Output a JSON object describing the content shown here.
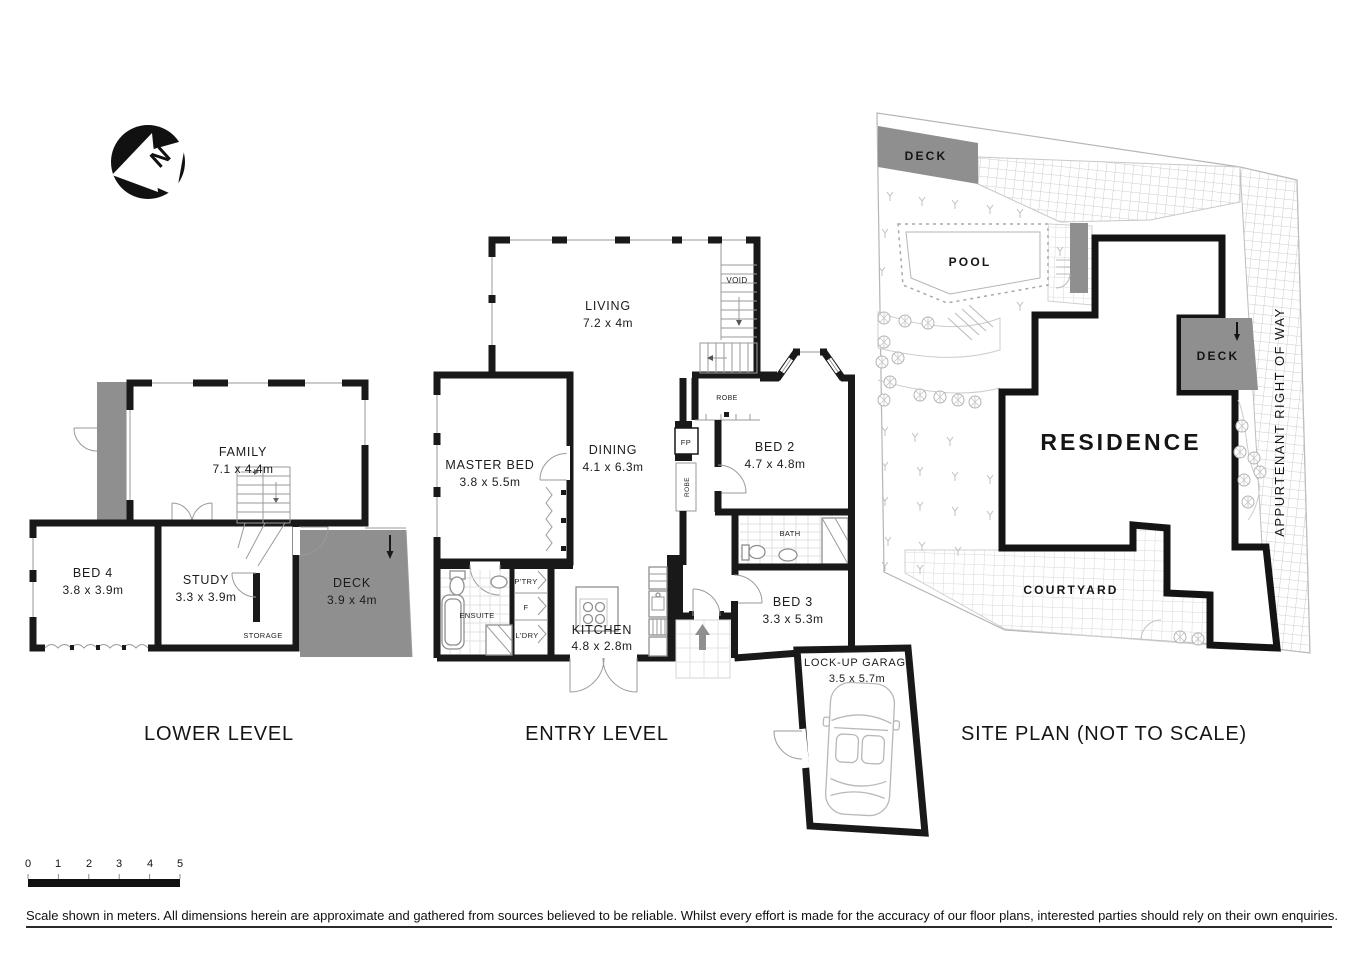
{
  "north": {
    "letter": "N"
  },
  "lower": {
    "title": "LOWER LEVEL",
    "family_name": "FAMILY",
    "family_dims": "7.1 x 4.4m",
    "bed4_name": "BED 4",
    "bed4_dims": "3.8 x 3.9m",
    "study_name": "STUDY",
    "study_dims": "3.3 x 3.9m",
    "storage": "STORAGE",
    "deck_name": "DECK",
    "deck_dims": "3.9 x 4m"
  },
  "entry": {
    "title": "ENTRY LEVEL",
    "living_name": "LIVING",
    "living_dims": "7.2 x 4m",
    "void": "VOID",
    "master_name": "MASTER BED",
    "master_dims": "3.8 x 5.5m",
    "dining_name": "DINING",
    "dining_dims": "4.1 x 6.3m",
    "bed2_name": "BED 2",
    "bed2_dims": "4.7 x 4.8m",
    "robe_top": "ROBE",
    "robe_side": "ROBE",
    "fp": "FP",
    "ensuite": "ENSUITE",
    "pantry": "P'TRY",
    "fridge": "F",
    "laundry": "L'DRY",
    "kitchen_name": "KITCHEN",
    "kitchen_dims": "4.8 x 2.8m",
    "bath": "BATH",
    "bed3_name": "BED 3",
    "bed3_dims": "3.3 x 5.3m",
    "garage_name": "LOCK-UP GARAGE",
    "garage_dims": "3.5 x 5.7m"
  },
  "site": {
    "title": "SITE PLAN (NOT TO SCALE)",
    "deck_top": "DECK",
    "pool": "POOL",
    "deck_right": "DECK",
    "residence": "RESIDENCE",
    "courtyard": "COURTYARD",
    "right_of_way": "APPURTENANT RIGHT OF WAY"
  },
  "scale": {
    "t0": "0",
    "t1": "1",
    "t2": "2",
    "t3": "3",
    "t4": "4",
    "t5": "5"
  },
  "disclaimer": "Scale shown in meters. All dimensions herein are approximate and gathered from sources believed to be  reliable. Whilst every effort is made for the accuracy of our floor plans, interested parties should rely on their own enquiries.",
  "colors": {
    "wall": "#191919",
    "deck": "#8f8f8f",
    "thin_line": "#9a9a9a"
  }
}
